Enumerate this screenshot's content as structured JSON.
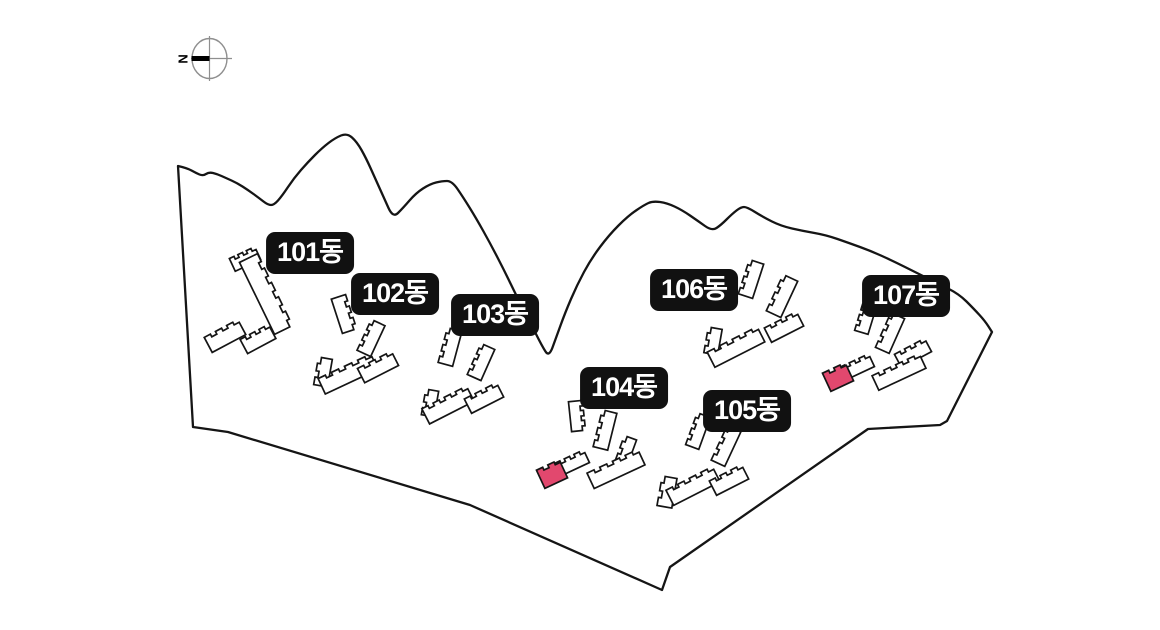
{
  "page": {
    "title": "apartment-complex-site-map",
    "background": "#ffffff"
  },
  "compass": {
    "letter": "N",
    "cx": 209.5,
    "cy": 58.5,
    "r": 17.5,
    "ring_color": "#8f8f8f",
    "needle_color": "#000000",
    "letter_x": 183,
    "letter_y": 59
  },
  "map": {
    "colors": {
      "boundary_stroke": "#151515",
      "building_stroke": "#151515",
      "building_fill": "#ffffff",
      "highlight_fill": "#e2486e",
      "label_bg": "#111111",
      "label_text": "#ffffff"
    },
    "boundary": {
      "top_points": [
        [
          178,
          166
        ],
        [
          187,
          168
        ],
        [
          196,
          173
        ],
        [
          203,
          176
        ],
        [
          209,
          172
        ],
        [
          217,
          174
        ],
        [
          226,
          178
        ],
        [
          237,
          183
        ],
        [
          248,
          190
        ],
        [
          259,
          198
        ],
        [
          268,
          205
        ],
        [
          274,
          205
        ],
        [
          282,
          196
        ],
        [
          294,
          178
        ],
        [
          308,
          162
        ],
        [
          322,
          148
        ],
        [
          335,
          138
        ],
        [
          347,
          133
        ],
        [
          357,
          142
        ],
        [
          366,
          158
        ],
        [
          375,
          178
        ],
        [
          384,
          198
        ],
        [
          393,
          218
        ],
        [
          403,
          208
        ],
        [
          416,
          193
        ],
        [
          430,
          184
        ],
        [
          442,
          181
        ],
        [
          452,
          181
        ],
        [
          463,
          197
        ],
        [
          476,
          218
        ],
        [
          490,
          243
        ],
        [
          504,
          270
        ],
        [
          518,
          299
        ],
        [
          531,
          324
        ],
        [
          542,
          346
        ],
        [
          549,
          357
        ],
        [
          556,
          338
        ],
        [
          565,
          313
        ],
        [
          577,
          285
        ],
        [
          591,
          259
        ],
        [
          609,
          235
        ],
        [
          628,
          216
        ],
        [
          644,
          205
        ],
        [
          653,
          201
        ],
        [
          667,
          203
        ],
        [
          682,
          210
        ],
        [
          698,
          221
        ],
        [
          712,
          231
        ],
        [
          721,
          225
        ],
        [
          732,
          214
        ],
        [
          741,
          207
        ],
        [
          747,
          207
        ],
        [
          763,
          217
        ],
        [
          781,
          226
        ],
        [
          803,
          231
        ],
        [
          826,
          235
        ],
        [
          849,
          243
        ],
        [
          871,
          251
        ],
        [
          893,
          261
        ],
        [
          915,
          272
        ],
        [
          937,
          283
        ],
        [
          959,
          294
        ],
        [
          974,
          309
        ],
        [
          985,
          321
        ],
        [
          992,
          332
        ]
      ],
      "bottom_points": [
        [
          947,
          421
        ],
        [
          940,
          425
        ],
        [
          868,
          429
        ],
        [
          670,
          567
        ],
        [
          662,
          590
        ],
        [
          470,
          505
        ],
        [
          228,
          432
        ],
        [
          193,
          427
        ]
      ]
    },
    "buildings": [
      {
        "bldg": "101",
        "x": 245,
        "y": 259,
        "len": 28,
        "wid": 14,
        "rot": -25,
        "teeth": 3,
        "highlight": false
      },
      {
        "bldg": "101",
        "x": 266,
        "y": 294,
        "len": 80,
        "wid": 20,
        "rot": 64,
        "teeth": 5,
        "highlight": false
      },
      {
        "bldg": "101",
        "x": 225,
        "y": 336,
        "len": 38,
        "wid": 17,
        "rot": -28,
        "teeth": 3,
        "highlight": false
      },
      {
        "bldg": "101",
        "x": 258,
        "y": 339,
        "len": 32,
        "wid": 16,
        "rot": -28,
        "teeth": 3,
        "highlight": false
      },
      {
        "bldg": "102",
        "x": 344,
        "y": 314,
        "len": 36,
        "wid": 15,
        "rot": 72,
        "teeth": 3,
        "highlight": false
      },
      {
        "bldg": "102",
        "x": 371,
        "y": 338,
        "len": 34,
        "wid": 15,
        "rot": -65,
        "teeth": 3,
        "highlight": false
      },
      {
        "bldg": "102",
        "x": 323,
        "y": 372,
        "len": 28,
        "wid": 14,
        "rot": -80,
        "teeth": 2,
        "highlight": false
      },
      {
        "bldg": "102",
        "x": 348,
        "y": 374,
        "len": 58,
        "wid": 17,
        "rot": -25,
        "teeth": 4,
        "highlight": false
      },
      {
        "bldg": "102",
        "x": 378,
        "y": 367,
        "len": 38,
        "wid": 16,
        "rot": -27,
        "teeth": 3,
        "highlight": false
      },
      {
        "bldg": "103",
        "x": 450,
        "y": 347,
        "len": 36,
        "wid": 15,
        "rot": -75,
        "teeth": 3,
        "highlight": false
      },
      {
        "bldg": "103",
        "x": 481,
        "y": 362,
        "len": 34,
        "wid": 15,
        "rot": -66,
        "teeth": 3,
        "highlight": false
      },
      {
        "bldg": "103",
        "x": 430,
        "y": 403,
        "len": 26,
        "wid": 13,
        "rot": -80,
        "teeth": 2,
        "highlight": false
      },
      {
        "bldg": "103",
        "x": 448,
        "y": 405,
        "len": 50,
        "wid": 17,
        "rot": -27,
        "teeth": 4,
        "highlight": false
      },
      {
        "bldg": "103",
        "x": 484,
        "y": 398,
        "len": 36,
        "wid": 16,
        "rot": -27,
        "teeth": 3,
        "highlight": false
      },
      {
        "bldg": "104",
        "x": 577,
        "y": 416,
        "len": 30,
        "wid": 14,
        "rot": 84,
        "teeth": 3,
        "highlight": false
      },
      {
        "bldg": "104",
        "x": 605,
        "y": 430,
        "len": 38,
        "wid": 15,
        "rot": -76,
        "teeth": 3,
        "highlight": false
      },
      {
        "bldg": "104",
        "x": 572,
        "y": 463,
        "len": 32,
        "wid": 14,
        "rot": -25,
        "teeth": 3,
        "highlight": false
      },
      {
        "bldg": "104",
        "x": 626,
        "y": 450,
        "len": 26,
        "wid": 13,
        "rot": -70,
        "teeth": 2,
        "highlight": false
      },
      {
        "bldg": "104",
        "x": 616,
        "y": 469,
        "len": 56,
        "wid": 17,
        "rot": -25,
        "teeth": 4,
        "highlight": false
      },
      {
        "bldg": "105",
        "x": 698,
        "y": 431,
        "len": 34,
        "wid": 14,
        "rot": -70,
        "teeth": 3,
        "highlight": false
      },
      {
        "bldg": "105",
        "x": 726,
        "y": 446,
        "len": 38,
        "wid": 15,
        "rot": -65,
        "teeth": 3,
        "highlight": false
      },
      {
        "bldg": "105",
        "x": 667,
        "y": 492,
        "len": 30,
        "wid": 15,
        "rot": -80,
        "teeth": 2,
        "highlight": false
      },
      {
        "bldg": "105",
        "x": 693,
        "y": 486,
        "len": 52,
        "wid": 17,
        "rot": -27,
        "teeth": 4,
        "highlight": false
      },
      {
        "bldg": "105",
        "x": 729,
        "y": 480,
        "len": 36,
        "wid": 16,
        "rot": -27,
        "teeth": 3,
        "highlight": false
      },
      {
        "bldg": "106",
        "x": 751,
        "y": 279,
        "len": 36,
        "wid": 15,
        "rot": -72,
        "teeth": 3,
        "highlight": false
      },
      {
        "bldg": "106",
        "x": 782,
        "y": 296,
        "len": 40,
        "wid": 16,
        "rot": -65,
        "teeth": 3,
        "highlight": false
      },
      {
        "bldg": "106",
        "x": 713,
        "y": 341,
        "len": 26,
        "wid": 14,
        "rot": -80,
        "teeth": 2,
        "highlight": false
      },
      {
        "bldg": "106",
        "x": 736,
        "y": 347,
        "len": 56,
        "wid": 17,
        "rot": -27,
        "teeth": 4,
        "highlight": false
      },
      {
        "bldg": "106",
        "x": 784,
        "y": 327,
        "len": 36,
        "wid": 16,
        "rot": -27,
        "teeth": 3,
        "highlight": false
      },
      {
        "bldg": "107",
        "x": 866,
        "y": 317,
        "len": 32,
        "wid": 14,
        "rot": -73,
        "teeth": 3,
        "highlight": false
      },
      {
        "bldg": "107",
        "x": 890,
        "y": 333,
        "len": 38,
        "wid": 15,
        "rot": -66,
        "teeth": 3,
        "highlight": false
      },
      {
        "bldg": "107",
        "x": 913,
        "y": 353,
        "len": 34,
        "wid": 15,
        "rot": -28,
        "teeth": 3,
        "highlight": false
      },
      {
        "bldg": "107",
        "x": 857,
        "y": 367,
        "len": 32,
        "wid": 14,
        "rot": -25,
        "teeth": 3,
        "highlight": false
      },
      {
        "bldg": "107",
        "x": 899,
        "y": 372,
        "len": 52,
        "wid": 16,
        "rot": -25,
        "teeth": 4,
        "highlight": false
      },
      {
        "bldg": "104",
        "x": 552,
        "y": 474,
        "len": 25,
        "wid": 20,
        "rot": -25,
        "teeth": 2,
        "highlight": true
      },
      {
        "bldg": "107",
        "x": 838,
        "y": 377,
        "len": 25,
        "wid": 20,
        "rot": -25,
        "teeth": 2,
        "highlight": true
      }
    ],
    "labels": [
      {
        "id": "101",
        "text": "101동",
        "x": 310,
        "y": 253
      },
      {
        "id": "102",
        "text": "102동",
        "x": 395,
        "y": 294
      },
      {
        "id": "103",
        "text": "103동",
        "x": 495,
        "y": 315
      },
      {
        "id": "104",
        "text": "104동",
        "x": 624,
        "y": 388
      },
      {
        "id": "105",
        "text": "105동",
        "x": 747,
        "y": 411
      },
      {
        "id": "106",
        "text": "106동",
        "x": 694,
        "y": 290
      },
      {
        "id": "107",
        "text": "107동",
        "x": 906,
        "y": 296
      }
    ]
  }
}
